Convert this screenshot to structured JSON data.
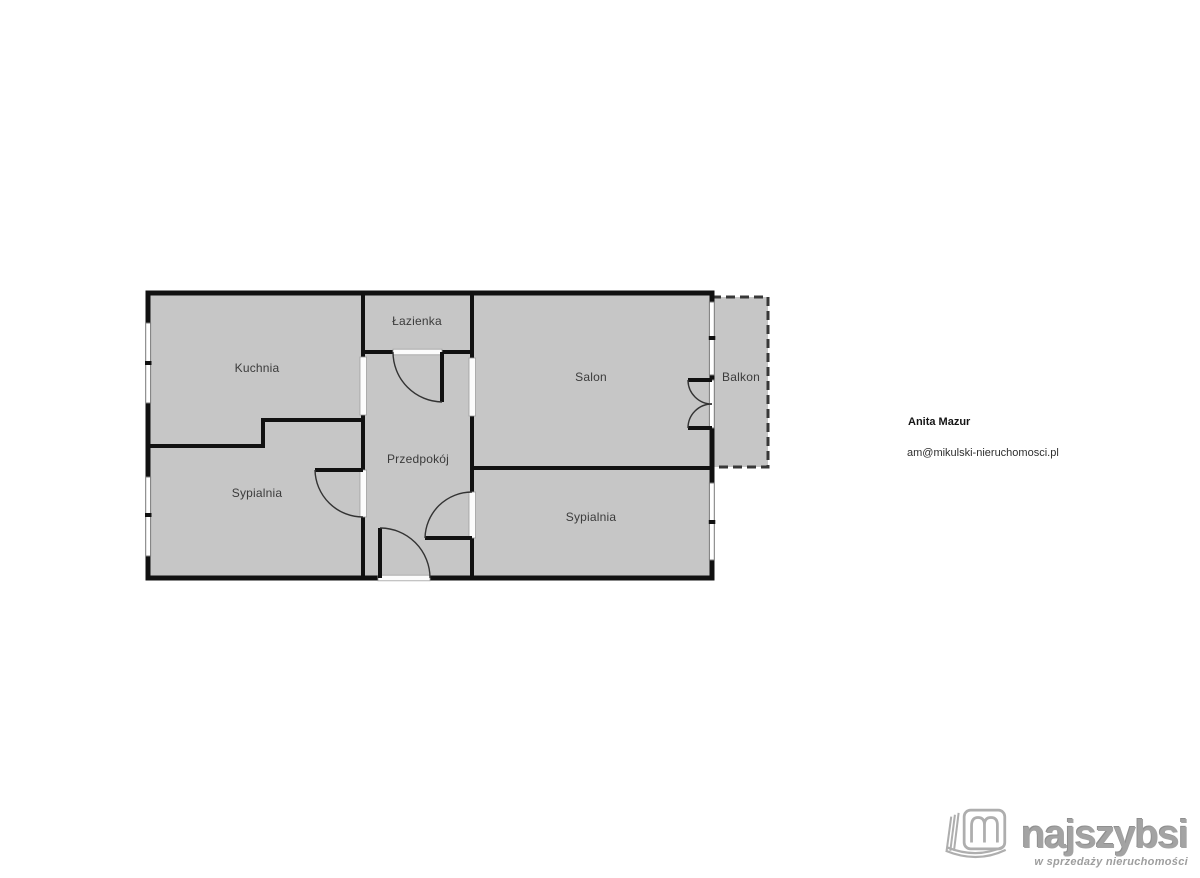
{
  "plan": {
    "room_fill": "#c6c6c6",
    "wall_color": "#111111",
    "rooms": [
      {
        "id": "lazienka",
        "label": "Łazienka"
      },
      {
        "id": "kuchnia",
        "label": "Kuchnia"
      },
      {
        "id": "salon",
        "label": "Salon"
      },
      {
        "id": "balkon",
        "label": "Balkon"
      },
      {
        "id": "przedpokoj",
        "label": "Przedpokój"
      },
      {
        "id": "sypialnia-left",
        "label": "Sypialnia"
      },
      {
        "id": "sypialnia-right",
        "label": "Sypialnia"
      }
    ]
  },
  "agent": {
    "name": "Anita Mazur",
    "email": "am@mikulski-nieruchomosci.pl"
  },
  "logo": {
    "brand": "najszybsi",
    "tagline": "w sprzedaży nieruchomości"
  }
}
